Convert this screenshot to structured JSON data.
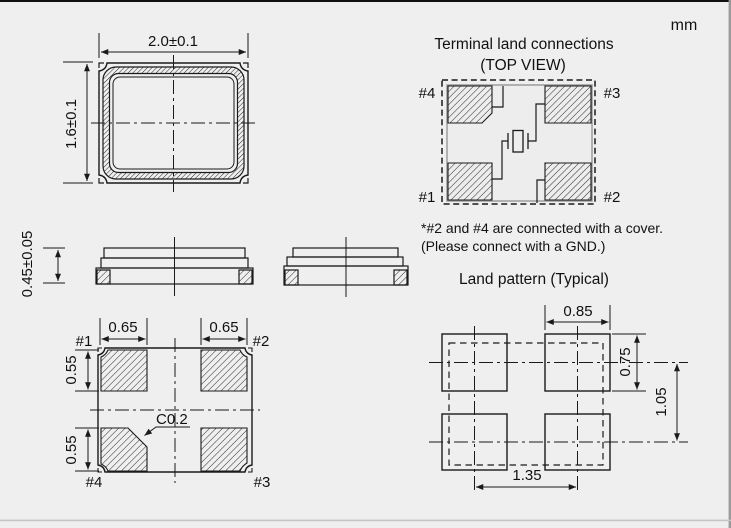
{
  "unit_label": "mm",
  "package_top_view": {
    "width_dim": "2.0±0.1",
    "height_dim": "1.6±0.1"
  },
  "side_view": {
    "height_dim": "0.45±0.05"
  },
  "bottom_view": {
    "pad_width_left": "0.65",
    "pad_width_right": "0.65",
    "pad_height_top": "0.55",
    "pad_height_bottom": "0.55",
    "chamfer": "C0.2",
    "pin1": "#1",
    "pin2": "#2",
    "pin3": "#3",
    "pin4": "#4"
  },
  "terminal_land_connections": {
    "title": "Terminal land connections",
    "subtitle": "(TOP VIEW)",
    "pin1": "#1",
    "pin2": "#2",
    "pin3": "#3",
    "pin4": "#4",
    "note_line1": "*#2 and #4 are connected with a cover.",
    "note_line2": "(Please connect with a GND.)"
  },
  "land_pattern": {
    "title": "Land pattern (Typical)",
    "pad_width": "0.85",
    "pad_height": "0.75",
    "vertical_pitch": "1.05",
    "horizontal_pitch": "1.35"
  },
  "colors": {
    "background": "#efefef",
    "line": "#1a1a1a",
    "frame_top": "#101010",
    "frame_right": "#9a9a9a",
    "divider": "#c4c4c4"
  }
}
